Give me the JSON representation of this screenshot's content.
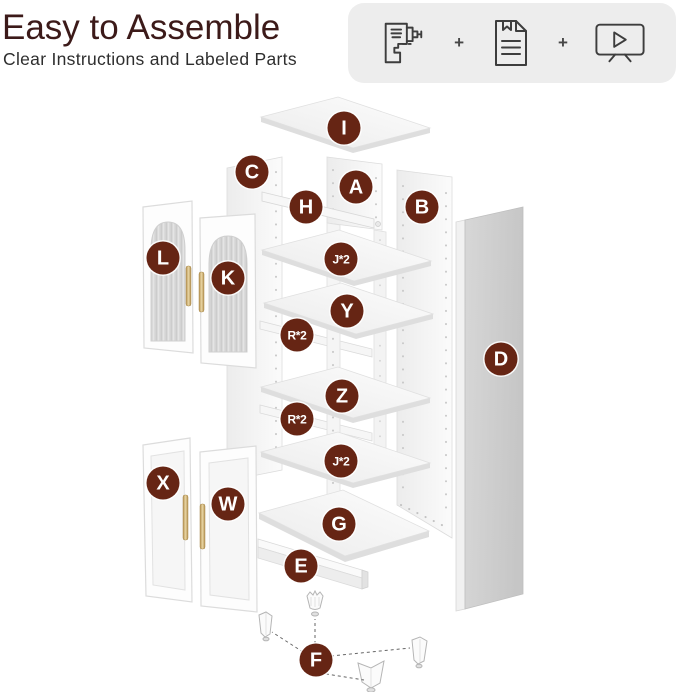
{
  "header": {
    "title": "Easy to Assemble",
    "subtitle": "Clear Instructions and Labeled Parts"
  },
  "icon_box": {
    "separator": "+",
    "icons": [
      {
        "name": "drill"
      },
      {
        "name": "instruction-manual"
      },
      {
        "name": "video-tutorial"
      }
    ]
  },
  "colors": {
    "accent_label_bg": "#662514",
    "title_text": "#3c1a19",
    "icon_box_bg": "#ededed"
  },
  "diagram": {
    "labels": [
      {
        "id": "I",
        "text": "I",
        "x": 344,
        "y": 128
      },
      {
        "id": "C",
        "text": "C",
        "x": 252,
        "y": 172
      },
      {
        "id": "A",
        "text": "A",
        "x": 356,
        "y": 187
      },
      {
        "id": "B",
        "text": "B",
        "x": 422,
        "y": 207
      },
      {
        "id": "H",
        "text": "H",
        "x": 306,
        "y": 207
      },
      {
        "id": "L",
        "text": "L",
        "x": 163,
        "y": 258
      },
      {
        "id": "K",
        "text": "K",
        "x": 228,
        "y": 278
      },
      {
        "id": "J-top",
        "text": "J*2",
        "x": 341,
        "y": 259
      },
      {
        "id": "Y",
        "text": "Y",
        "x": 347,
        "y": 311
      },
      {
        "id": "R-top",
        "text": "R*2",
        "x": 297,
        "y": 335
      },
      {
        "id": "Z",
        "text": "Z",
        "x": 342,
        "y": 396
      },
      {
        "id": "R-bottom",
        "text": "R*2",
        "x": 297,
        "y": 419
      },
      {
        "id": "J-bottom",
        "text": "J*2",
        "x": 341,
        "y": 461
      },
      {
        "id": "D",
        "text": "D",
        "x": 501,
        "y": 359
      },
      {
        "id": "X",
        "text": "X",
        "x": 163,
        "y": 483
      },
      {
        "id": "W",
        "text": "W",
        "x": 228,
        "y": 504
      },
      {
        "id": "G",
        "text": "G",
        "x": 339,
        "y": 524
      },
      {
        "id": "E",
        "text": "E",
        "x": 301,
        "y": 566
      },
      {
        "id": "F",
        "text": "F",
        "x": 316,
        "y": 660
      }
    ]
  }
}
